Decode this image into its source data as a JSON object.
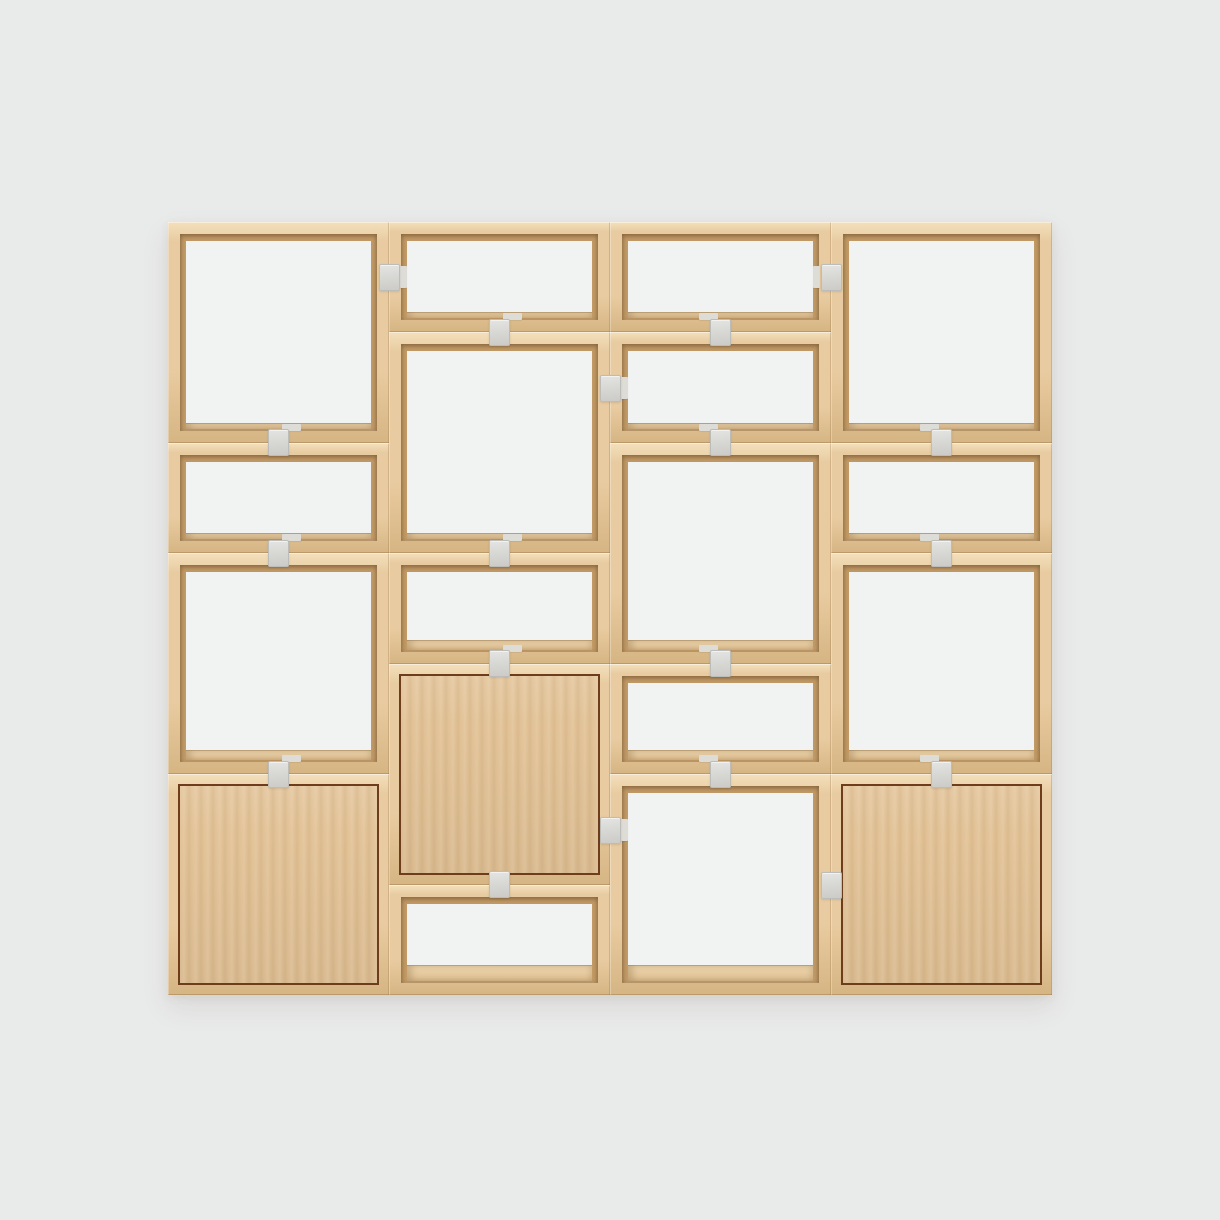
{
  "subject": "Product photo of a modular stacked shelving system in light oak: four columns of open storage cubes in two module heights, three cabinet modules with wood doors, connected by small grey clips, centered on a plain light-grey backdrop",
  "canvas": {
    "width": 1220,
    "height": 1220
  },
  "palette": {
    "bg": "#e9eaea",
    "frame": "#e8cba0",
    "frame_hi": "#f3e0bc",
    "frame_lo": "#d6b583",
    "bevel": "#c29b67",
    "interior": "#f1f2f2",
    "shelf_hi": "#eed6ae",
    "shelf": "#dfc092",
    "door": "#e2c296",
    "door_outline": "#6e3e1c",
    "clip": "#d7d7d4",
    "clip_border": "#bcbcb9",
    "clip_back": "#dedcd7"
  },
  "unit": {
    "left": 168,
    "top": 222,
    "width": 884,
    "height": 773,
    "columns": 4,
    "half_rows": 7,
    "frame_thickness": 12,
    "door_inset": 10
  },
  "modules": [
    {
      "column": 0,
      "half_start": 0,
      "half_span": 2,
      "type": "open"
    },
    {
      "column": 0,
      "half_start": 2,
      "half_span": 1,
      "type": "open"
    },
    {
      "column": 0,
      "half_start": 3,
      "half_span": 2,
      "type": "open"
    },
    {
      "column": 0,
      "half_start": 5,
      "half_span": 2,
      "type": "door"
    },
    {
      "column": 1,
      "half_start": 0,
      "half_span": 1,
      "type": "open"
    },
    {
      "column": 1,
      "half_start": 1,
      "half_span": 2,
      "type": "open"
    },
    {
      "column": 1,
      "half_start": 3,
      "half_span": 1,
      "type": "open"
    },
    {
      "column": 1,
      "half_start": 4,
      "half_span": 2,
      "type": "door"
    },
    {
      "column": 1,
      "half_start": 6,
      "half_span": 1,
      "type": "open"
    },
    {
      "column": 2,
      "half_start": 0,
      "half_span": 1,
      "type": "open"
    },
    {
      "column": 2,
      "half_start": 1,
      "half_span": 1,
      "type": "open"
    },
    {
      "column": 2,
      "half_start": 2,
      "half_span": 2,
      "type": "open"
    },
    {
      "column": 2,
      "half_start": 4,
      "half_span": 1,
      "type": "open"
    },
    {
      "column": 2,
      "half_start": 5,
      "half_span": 2,
      "type": "open"
    },
    {
      "column": 3,
      "half_start": 0,
      "half_span": 2,
      "type": "open"
    },
    {
      "column": 3,
      "half_start": 2,
      "half_span": 1,
      "type": "open"
    },
    {
      "column": 3,
      "half_start": 3,
      "half_span": 2,
      "type": "open"
    },
    {
      "column": 3,
      "half_start": 5,
      "half_span": 2,
      "type": "door"
    }
  ],
  "junction_clips": [
    {
      "column": 0,
      "half": 2
    },
    {
      "column": 0,
      "half": 3
    },
    {
      "column": 0,
      "half": 5
    },
    {
      "column": 1,
      "half": 1
    },
    {
      "column": 1,
      "half": 3
    },
    {
      "column": 1,
      "half": 4
    },
    {
      "column": 1,
      "half": 6,
      "back_hidden": true
    },
    {
      "column": 2,
      "half": 1
    },
    {
      "column": 2,
      "half": 2
    },
    {
      "column": 2,
      "half": 4
    },
    {
      "column": 2,
      "half": 5
    },
    {
      "column": 3,
      "half": 2
    },
    {
      "column": 3,
      "half": 3
    },
    {
      "column": 3,
      "half": 5
    }
  ],
  "seam_clips": [
    {
      "seam": 1,
      "y_center": 277
    },
    {
      "seam": 2,
      "y_center": 388
    },
    {
      "seam": 2,
      "y_center": 830
    },
    {
      "seam": 3,
      "y_center": 277
    },
    {
      "seam": 3,
      "y_center": 885,
      "back_hidden": true
    }
  ],
  "clip_size": {
    "width": 21,
    "height": 27
  },
  "clip_back_tab": {
    "junction": {
      "width": 19,
      "height": 7,
      "dx_near": 3,
      "dx_far": -22,
      "dy": -19
    },
    "seam": {
      "width": 7,
      "height": 22,
      "dx_near": 11,
      "dx_far": -18
    }
  }
}
